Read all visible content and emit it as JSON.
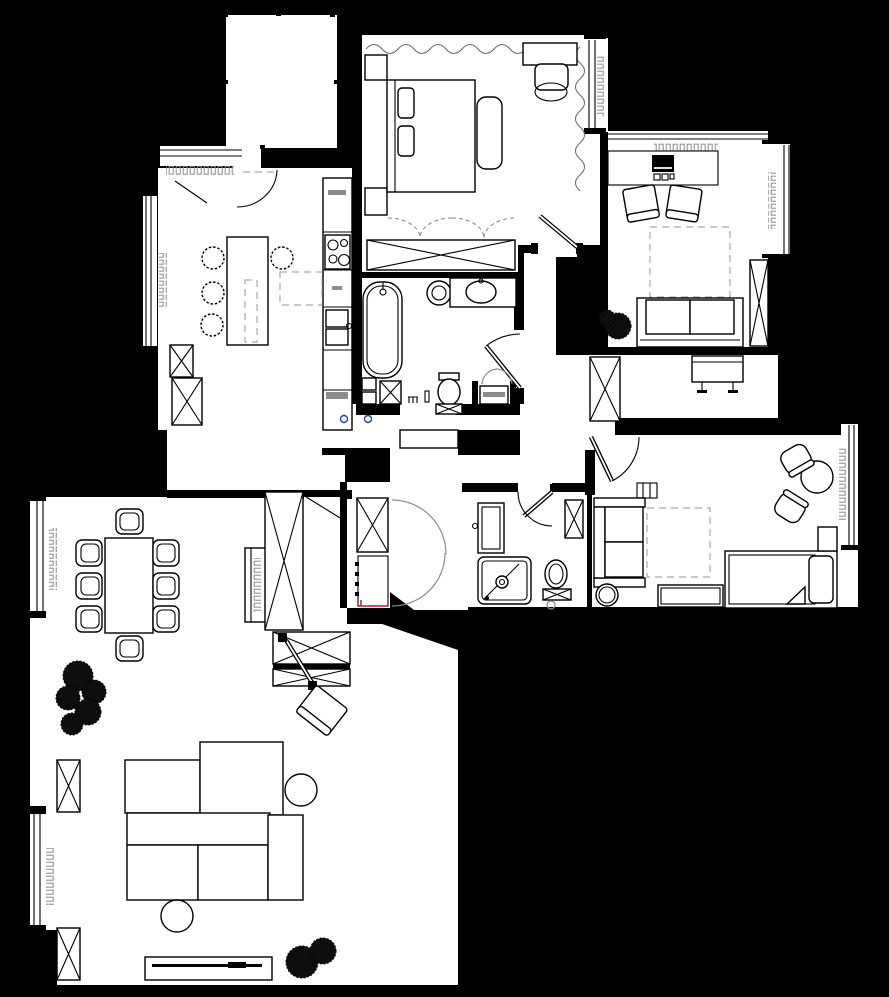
{
  "palette": {
    "bg": "#000000",
    "floor": "#ffffff",
    "ink": "#000000",
    "muted": "#8c8c8c",
    "dash": "#a9a9a9",
    "accent-red": "#cc2222",
    "accent-blue": "#2244bb"
  },
  "plan": {
    "type": "floor-plan",
    "style": "architectural black-and-white apartment plan on black background",
    "rooms": [
      {
        "name": "balcony",
        "furniture": [
          "empty deck with survey tick marks"
        ]
      },
      {
        "name": "master bedroom",
        "furniture": [
          "double bed",
          "two nightstands",
          "bedside bench",
          "desk",
          "pouf",
          "window curtains",
          "built-in wardrobe with dashed folding doors",
          "window radiator"
        ]
      },
      {
        "name": "studio lounge",
        "furniture": [
          "desk with monitor",
          "two lounge chairs",
          "dashed rug",
          "two-seat sofa",
          "plant",
          "tall crossed cabinet",
          "window radiator"
        ]
      },
      {
        "name": "kitchen",
        "furniture": [
          "island with four bar stools",
          "cooktop with four burners",
          "double sink",
          "counter run with grey handles",
          "two crossed base cabinets",
          "dashed rug",
          "window radiators"
        ]
      },
      {
        "name": "main bathroom",
        "furniture": [
          "bathtub",
          "round basin",
          "counter basin",
          "toilet with crossed base",
          "crossed cabinet",
          "washing machine niche with grey doors",
          "toilet brush set"
        ]
      },
      {
        "name": "entry hall",
        "furniture": [
          "door mat",
          "console bench",
          "crossed wardrobe",
          "two blue floor drains"
        ]
      },
      {
        "name": "storage nook",
        "furniture": [
          "crossed cabinet",
          "shelf unit with red marker",
          "grey double swing doors"
        ]
      },
      {
        "name": "shower room",
        "furniture": [
          "vanity basin",
          "shower tray with drain",
          "toilet with grey flush circle",
          "crossed wall cabinet"
        ]
      },
      {
        "name": "second bedroom",
        "furniture": [
          "sofa bed",
          "ladder rail",
          "dashed rug",
          "single bed with folded blanket",
          "nightstand",
          "drawer chest",
          "round table with two chairs",
          "round pouf",
          "window radiator"
        ]
      },
      {
        "name": "living dining room",
        "furniture": [
          "dining table with eight chairs",
          "media sideboard",
          "tall crossed wardrobe",
          "entry door",
          "modular corner sofa",
          "two round side tables",
          "rotated armchair",
          "TV bench with television",
          "plants",
          "two window radiators",
          "two crossed cabinets"
        ]
      }
    ]
  }
}
